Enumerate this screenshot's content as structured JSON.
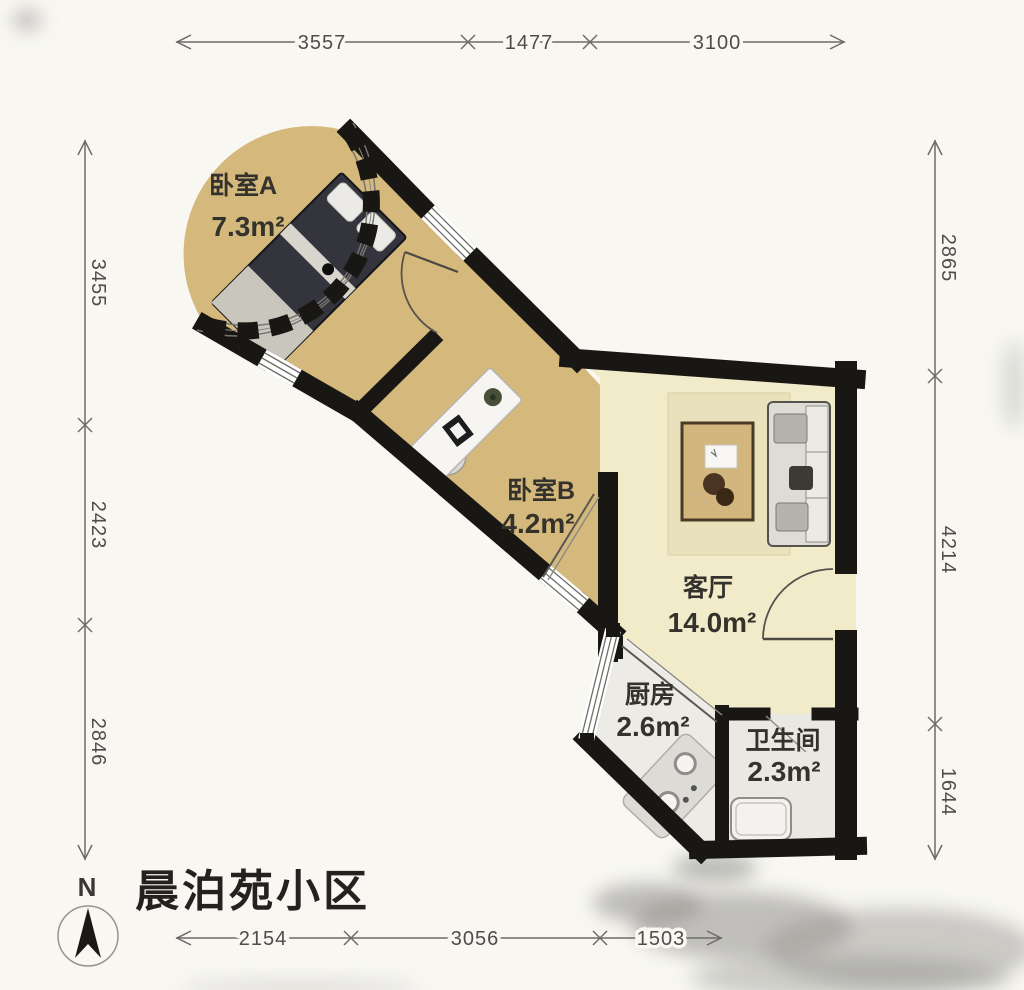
{
  "title": "晨泊苑小区",
  "compass": {
    "label": "N"
  },
  "rooms": [
    {
      "id": "bedroom-a",
      "name": "卧室A",
      "area": "7.3m²"
    },
    {
      "id": "bedroom-b",
      "name": "卧室B",
      "area": "4.2m²"
    },
    {
      "id": "living-room",
      "name": "客厅",
      "area": "14.0m²"
    },
    {
      "id": "kitchen",
      "name": "厨房",
      "area": "2.6m²"
    },
    {
      "id": "bathroom",
      "name": "卫生间",
      "area": "2.3m²"
    }
  ],
  "dims": {
    "top": [
      "3557",
      "1477",
      "3100"
    ],
    "left": [
      "3455",
      "2423",
      "2846"
    ],
    "right": [
      "2865",
      "4214",
      "1644"
    ],
    "bottom": [
      "2154",
      "3056",
      "1503"
    ]
  },
  "colors": {
    "background": "#f8f7f2",
    "wall": "#191714",
    "floor_bedroom": "#d5b87b",
    "floor_living": "#f2ebca",
    "floor_wet": "#edebe6",
    "rug": "#e9e0bc",
    "dimension_line": "#6e6c68",
    "label_text": "#34322d"
  }
}
